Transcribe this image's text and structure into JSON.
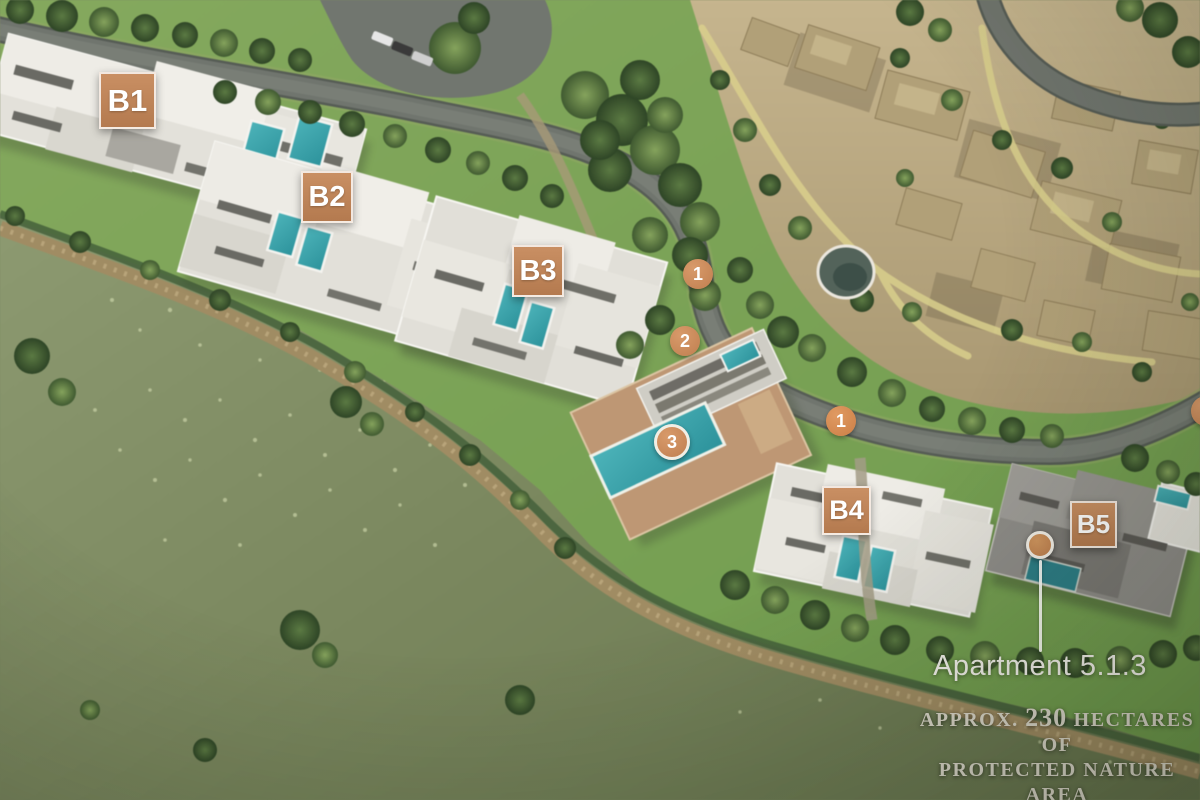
{
  "building_labels": [
    {
      "label": "B1"
    },
    {
      "label": "B2"
    },
    {
      "label": "B3"
    },
    {
      "label": "B4"
    },
    {
      "label": "B5"
    }
  ],
  "route_markers": [
    {
      "label": "1"
    },
    {
      "label": "2"
    },
    {
      "label": "3"
    },
    {
      "label": "1"
    }
  ],
  "annotation": {
    "label": "Apartment 5.1.3"
  },
  "caption": {
    "prefix": "APPROX.",
    "number": "230",
    "suffix": "HECTARES OF",
    "line2": "PROTECTED NATURE AREA"
  },
  "colors": {
    "label_accent": "#c08257",
    "marker_ring": "#f1eee4",
    "pool": "#39a3ab"
  }
}
